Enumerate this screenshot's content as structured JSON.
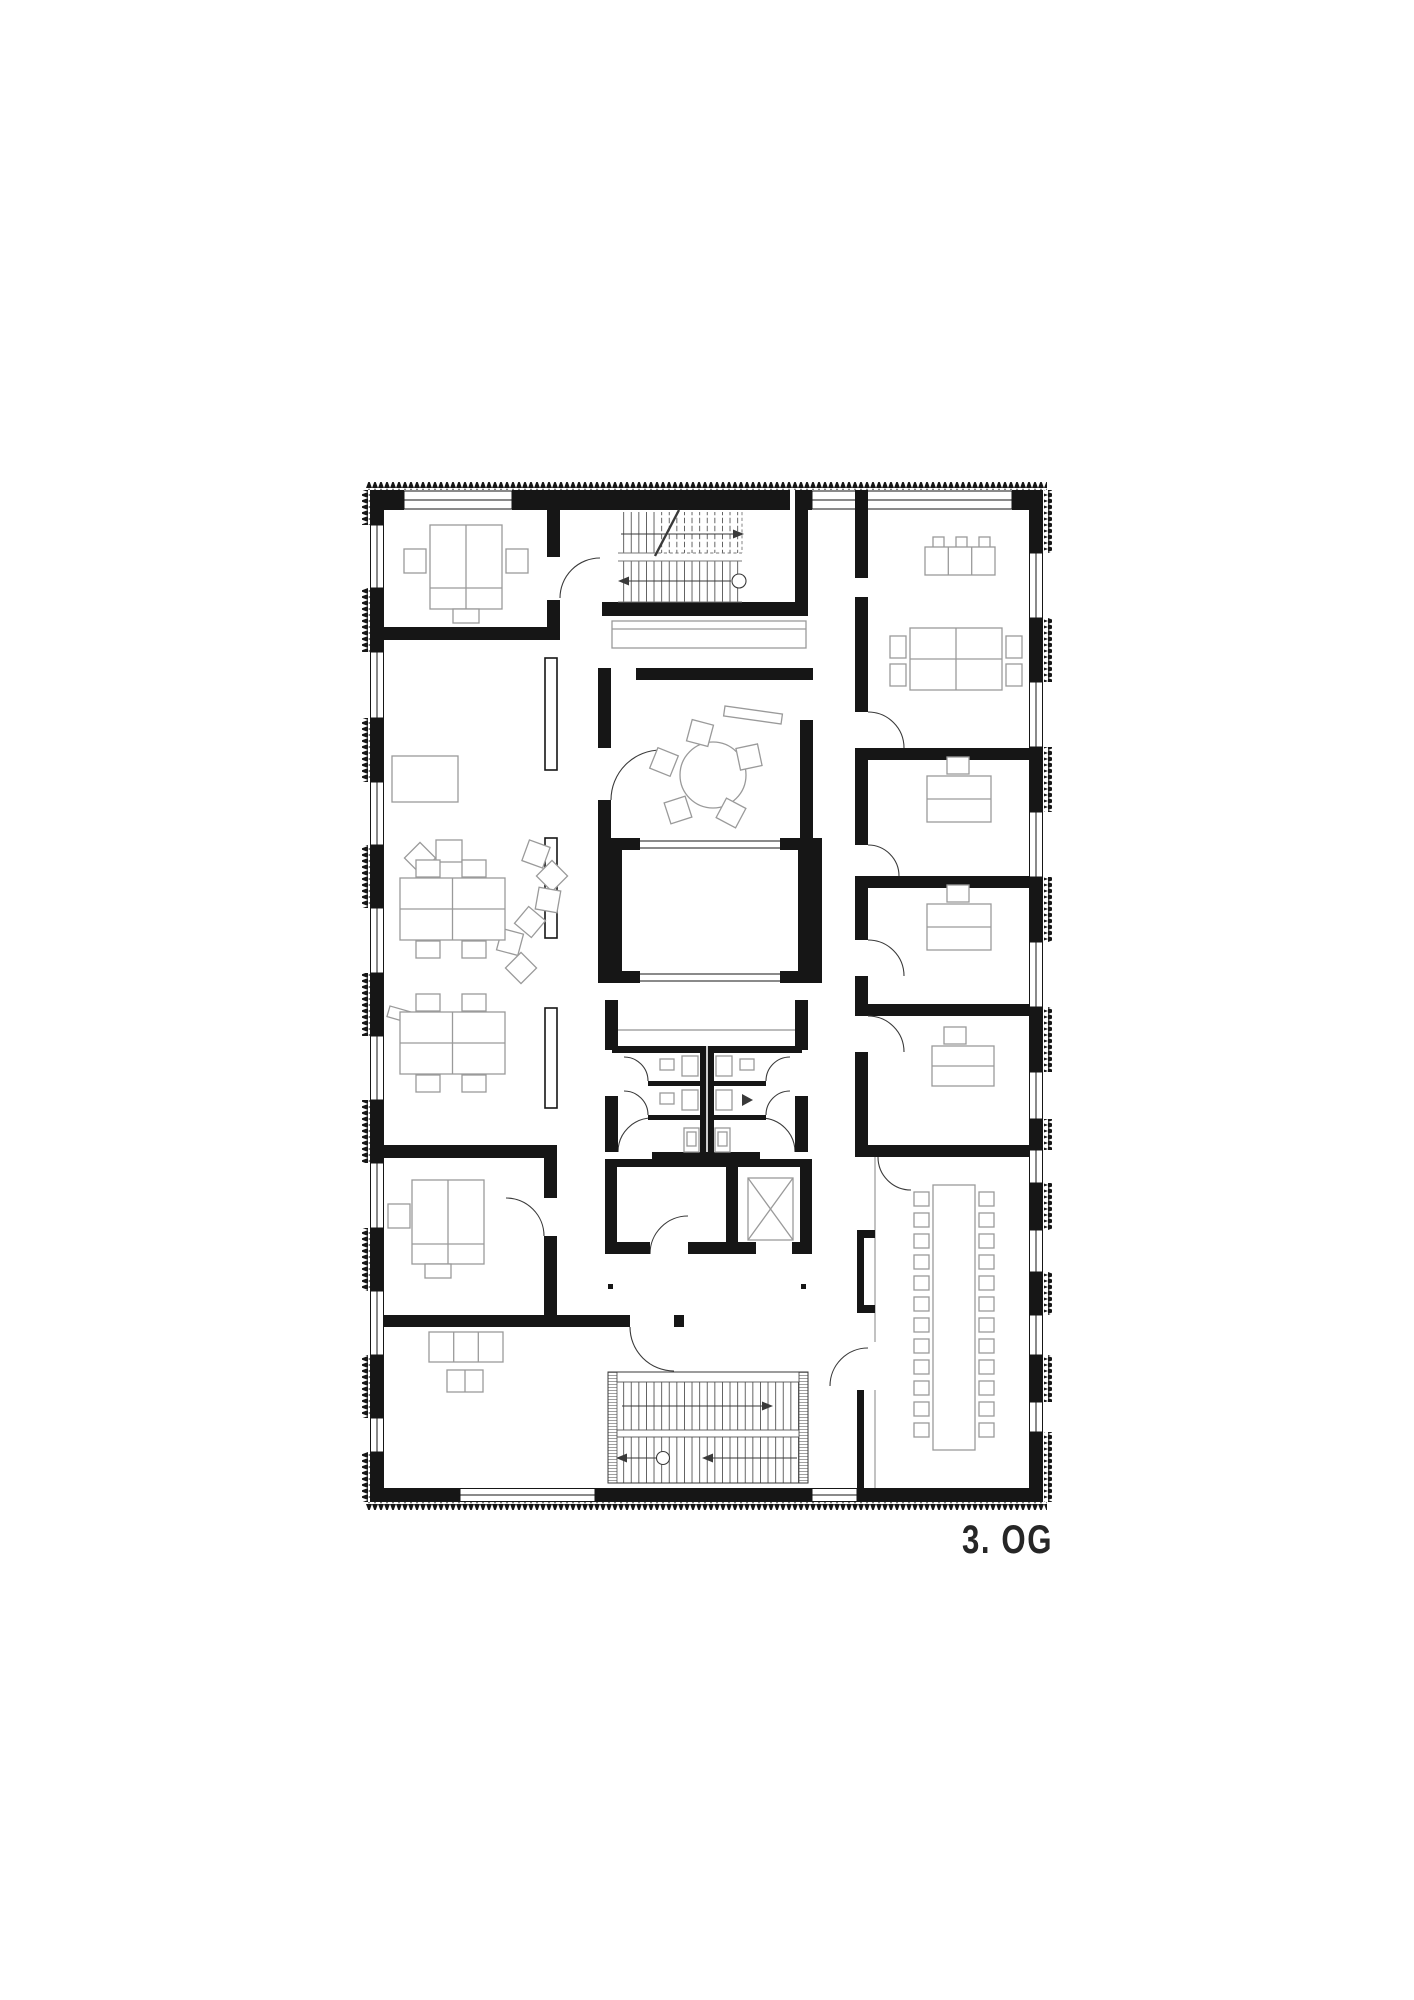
{
  "plan": {
    "floor_label": "3. OG",
    "colors": {
      "background": "#ffffff",
      "walls": "#161616",
      "furniture_lines": "#9a9a9a",
      "annotation_lines": "#3a3a3a"
    },
    "annotations": {
      "stair_up_arrow": "stair-direction-arrow",
      "stair_start_circle": "stair-start-marker"
    }
  }
}
